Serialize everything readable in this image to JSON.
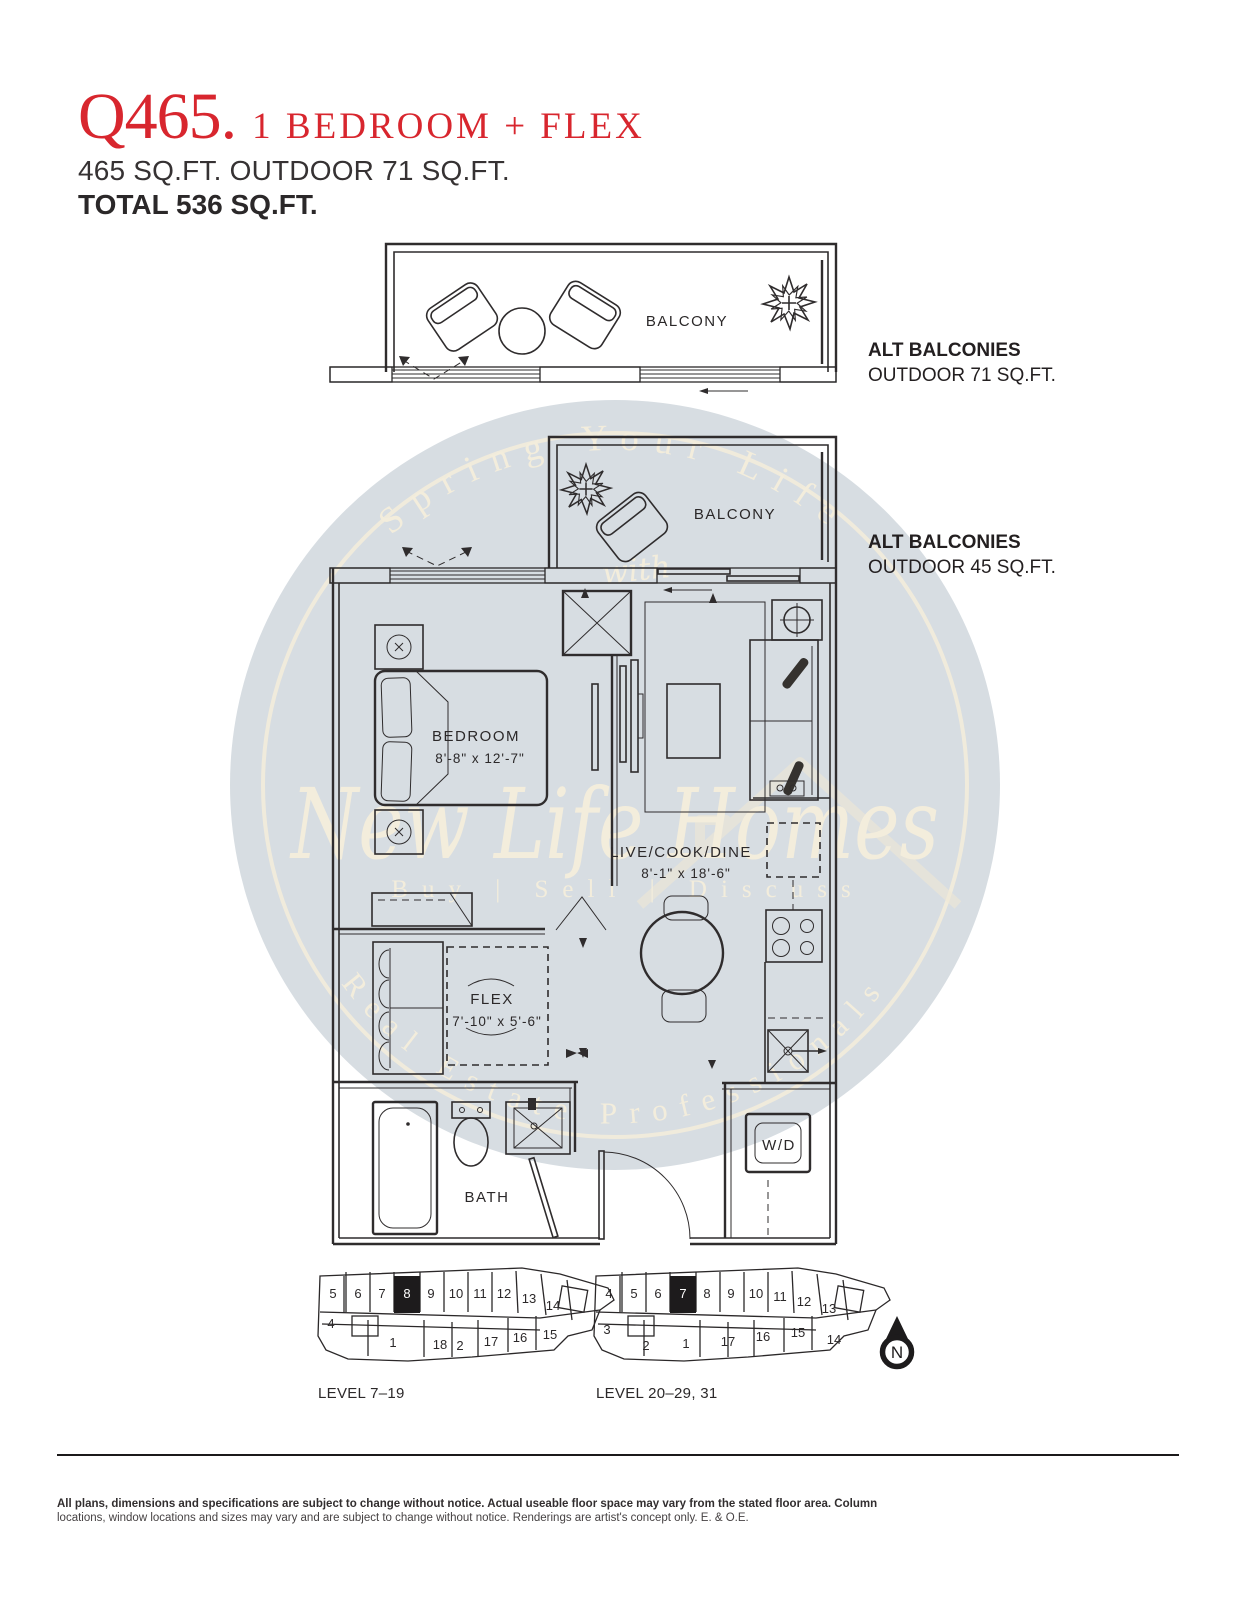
{
  "header": {
    "code": "Q465.",
    "type": "1 BEDROOM + FLEX",
    "area": "465 SQ.FT. OUTDOOR 71 SQ.FT.",
    "total": "TOTAL 536 SQ.FT."
  },
  "annotations": {
    "alt1_title": "ALT BALCONIES",
    "alt1_sub": "OUTDOOR 71 SQ.FT.",
    "alt2_title": "ALT BALCONIES",
    "alt2_sub": "OUTDOOR 45 SQ.FT."
  },
  "plan": {
    "balcony_top": "BALCONY",
    "balcony_mid": "BALCONY",
    "bedroom_name": "BEDROOM",
    "bedroom_dims": "8'-8\" x 12'-7\"",
    "living_name": "LIVE/COOK/DINE",
    "living_dims": "8'-1\" x 18'-6\"",
    "flex_name": "FLEX",
    "flex_dims": "7'-10\" x 5'-6\"",
    "bath": "BATH",
    "wd": "W/D"
  },
  "watermark": {
    "arc_top": "Spring Your Life",
    "script_with": "with",
    "script_main": "New Life Homes",
    "tagline": "Buy | Sell | Discuss",
    "arc_bottom": "Real Estate Professionals"
  },
  "keyplans": {
    "left": {
      "caption": "LEVEL 7–19",
      "top_units": [
        "5",
        "6",
        "7",
        "8",
        "9",
        "10",
        "11",
        "12",
        "13",
        "14"
      ],
      "side_unit": "4",
      "bottom_units": [
        "1",
        "18",
        "2",
        "17",
        "16",
        "15"
      ],
      "highlighted_unit": "8"
    },
    "right": {
      "caption": "LEVEL 20–29, 31",
      "top_units": [
        "4",
        "5",
        "6",
        "7",
        "8",
        "9",
        "10",
        "11",
        "12",
        "13"
      ],
      "side_unit": "3",
      "bottom_units": [
        "2",
        "1",
        "17",
        "16",
        "15",
        "14"
      ],
      "highlighted_unit": "7"
    }
  },
  "compass": {
    "label": "N"
  },
  "footer": {
    "line1": "All plans, dimensions and specifications are subject to change without notice. Actual useable floor space may vary from the stated floor area. Column",
    "line2": "locations, window locations and sizes may vary and are subject to change without notice. Renderings are artist's concept only. E. & O.E."
  },
  "colors": {
    "accent_red": "#d8262e",
    "ink": "#231f20",
    "plan_line": "#2f2c2d",
    "watermark_fill": "#d7dde2",
    "watermark_text": "#f3eddc"
  }
}
